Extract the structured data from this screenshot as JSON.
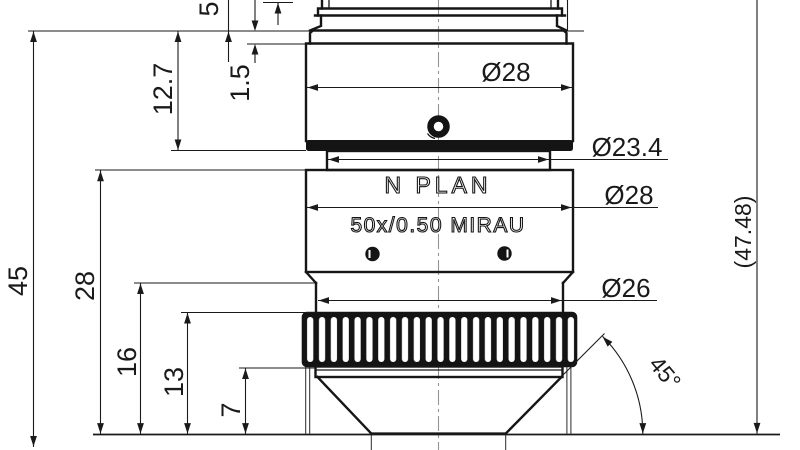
{
  "drawing": {
    "kind": "technical-drawing",
    "subject": "microscope-objective-cross-section",
    "colors": {
      "line": "#1a1a1a",
      "centerline": "#999999",
      "background": "#ffffff",
      "fill_dark": "#141414"
    },
    "engraving": {
      "line1": "N PLAN",
      "line2": "50x/0.50 MIRAU"
    },
    "linear_dimensions": {
      "parfocal": "45",
      "mid_body_height": "28",
      "knurl_top_to_tip": "16",
      "knurl_mid_to_tip": "13",
      "cone_height": "7",
      "upper_body": "12.7",
      "flange_step": "1.5",
      "thread_length": "5"
    },
    "diameters": {
      "upper_barrel": "Ø28",
      "neck": "Ø23.4",
      "mid_barrel": "Ø28",
      "lower_barrel": "Ø26"
    },
    "overall_length": "(47.48)",
    "cone_angle": "45°"
  }
}
